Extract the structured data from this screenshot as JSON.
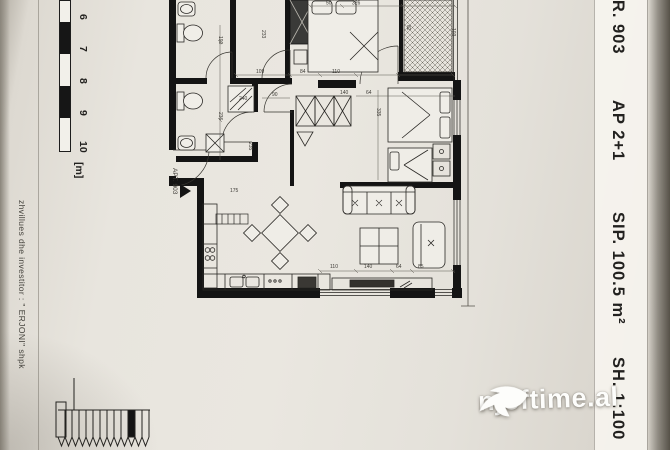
{
  "sheet": {
    "right_strip": {
      "items": [
        "NR. 903",
        "AP 2+1",
        "SIP. 100.5 m²",
        "SH. 1:100"
      ]
    },
    "left_text": "zhvillues dhe investitor :  \" ERJONI\"  shpk",
    "scale": {
      "ticks": [
        "6",
        "7",
        "8",
        "9",
        "10"
      ],
      "unit": "[m]"
    },
    "apt_label": "APT. 903"
  },
  "plan": {
    "dims": {
      "a190": "190",
      "a233": "233",
      "a50": "50",
      "a326": "326",
      "a82": "82",
      "a103": "103",
      "a109": "109",
      "a84": "84",
      "a110": "110",
      "a90": "90",
      "a140": "140",
      "a64": "64",
      "a240": "240",
      "a236": "236",
      "a235": "235",
      "a335": "335",
      "a175": "175",
      "b110": "110",
      "b140": "140",
      "b64": "64",
      "b85": "85"
    }
  },
  "watermark": {
    "text": "njoftime.al"
  }
}
